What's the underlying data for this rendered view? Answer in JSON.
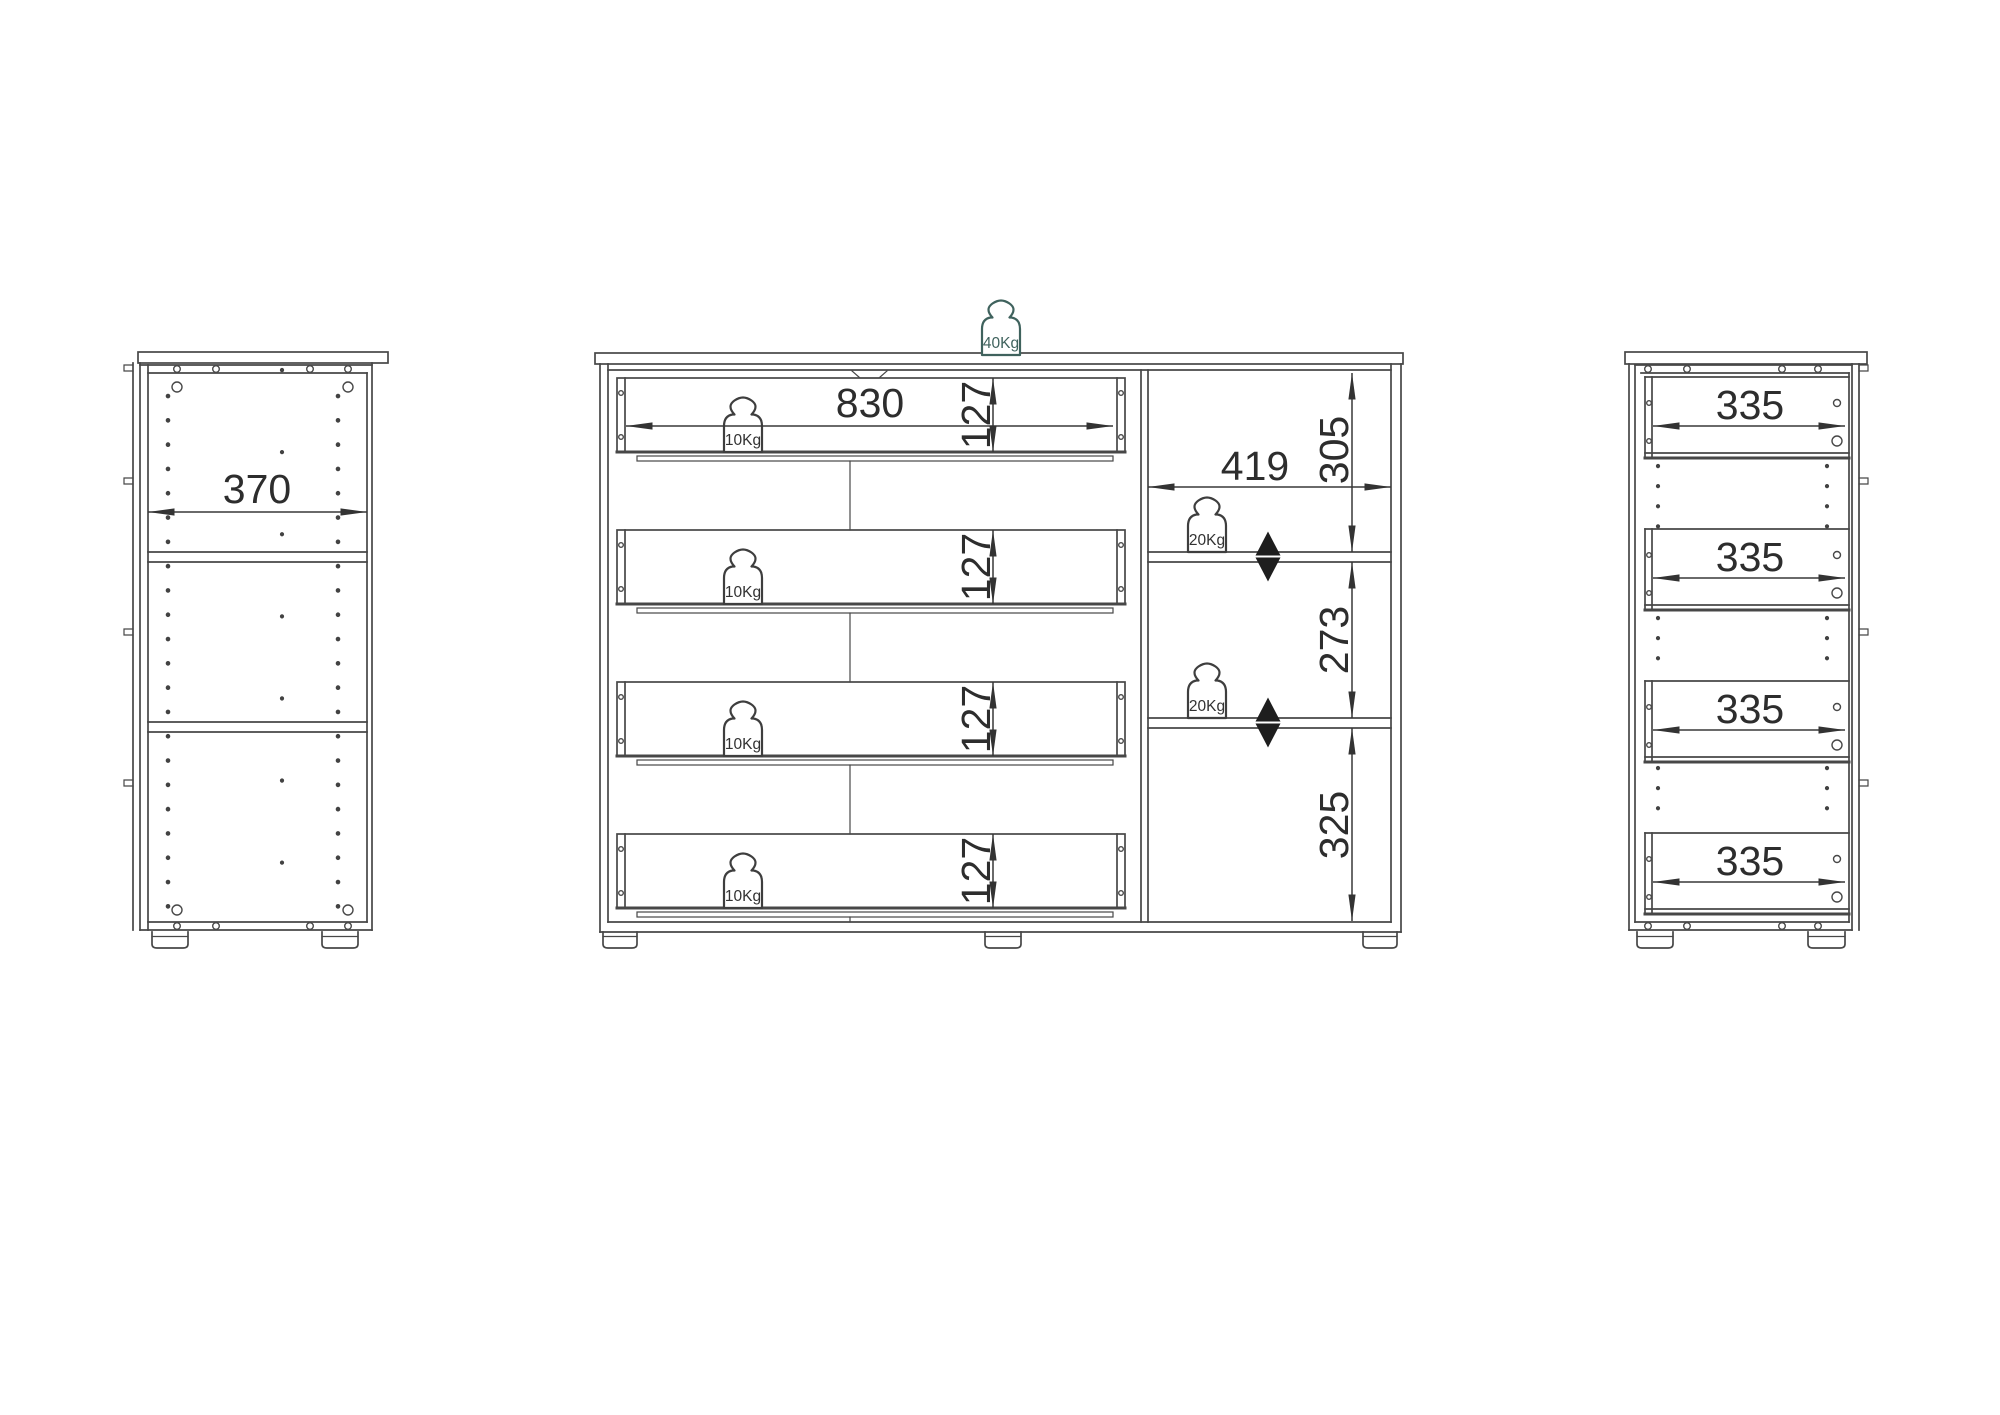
{
  "colors": {
    "line": "#474747",
    "dimension_text": "#2d2d2d",
    "top_load_accent": "#3f625d"
  },
  "left_view": {
    "depth_dim": "370"
  },
  "front_view": {
    "top_load": "40Kg",
    "drawer_width_dim": "830",
    "drawers": [
      {
        "height_dim": "127",
        "load": "10Kg"
      },
      {
        "height_dim": "127",
        "load": "10Kg"
      },
      {
        "height_dim": "127",
        "load": "10Kg"
      },
      {
        "height_dim": "127",
        "load": "10Kg"
      }
    ],
    "compartment": {
      "width_dim": "419",
      "top_height_dim": "305",
      "middle_height_dim": "273",
      "bottom_height_dim": "325",
      "shelf_loads": [
        "20Kg",
        "20Kg"
      ]
    }
  },
  "right_view": {
    "drawers": [
      {
        "depth_dim": "335"
      },
      {
        "depth_dim": "335"
      },
      {
        "depth_dim": "335"
      },
      {
        "depth_dim": "335"
      }
    ]
  }
}
